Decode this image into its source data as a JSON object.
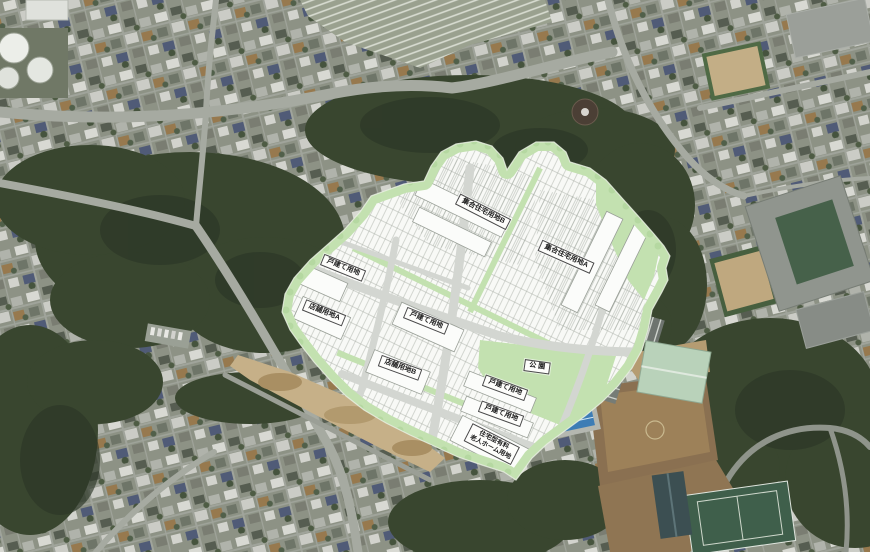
{
  "map": {
    "labels": {
      "apartment_b": "集合住宅用地B",
      "apartment_a": "集合住宅用地A",
      "detached": "戸建て用地",
      "shop_a": "店舗用地A",
      "shop_b": "店舗用地B",
      "park": "公 園",
      "nursing_home_line1": "住宅型有料",
      "nursing_home_line2": "老人ホーム用地"
    },
    "colors": {
      "site_green": "#c3e1b0",
      "plan_white": "#f8f9f6",
      "plan_road": "#d3d6d1",
      "label_border": "#4a4a4a",
      "forest_green": "#39462f",
      "urban_base": "#8d9285",
      "dirt_tan": "#c6b088",
      "field_brown": "#8a7051",
      "pool_blue": "#3d7db5",
      "gym_roof": "#b9d2ba",
      "court_green": "#3f5f4b"
    }
  }
}
